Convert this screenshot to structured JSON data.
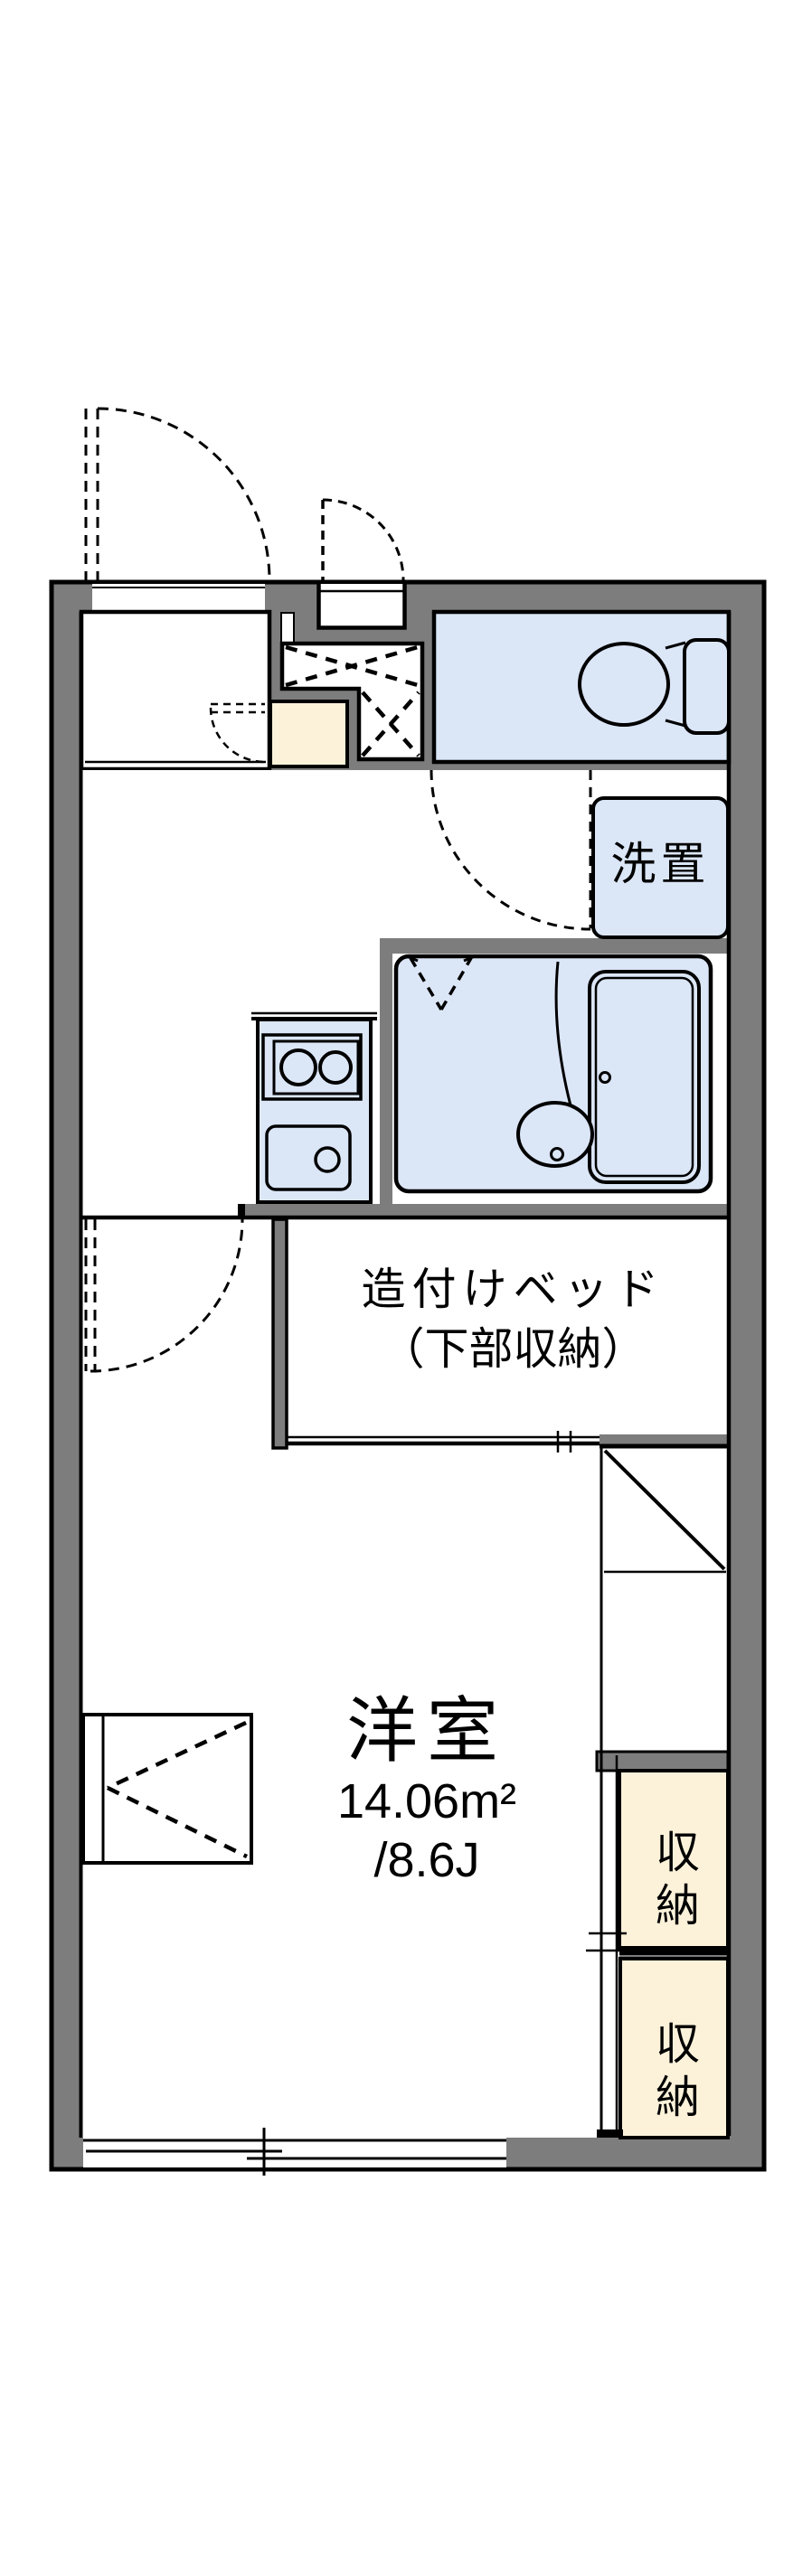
{
  "floorplan": {
    "type": "apartment-floor-plan",
    "labels": {
      "laundry": "洗置",
      "bed_line1": "造付けベッド",
      "bed_line2": "（下部収納）",
      "main_room_name": "洋室",
      "main_room_area_m2": "14.06m²",
      "main_room_area_tatami": "/8.6J",
      "closet_upper": "収納",
      "closet_lower": "収納"
    },
    "colors": {
      "wall_gray": "#7d7d7d",
      "wet_area_blue": "#dbe6f7",
      "storage_cream": "#fcf2da",
      "line_black": "#000000",
      "background_white": "#ffffff"
    },
    "features": [
      "entrance-door-swing",
      "porch-door-swing",
      "overhead-cabinet-cross-marks",
      "toilet",
      "washing-machine-space",
      "bathroom-with-tub",
      "kitchen-stove-and-sink",
      "built-in-bed",
      "built-in-desk",
      "closet-sliding-doors",
      "sliding-window"
    ]
  }
}
